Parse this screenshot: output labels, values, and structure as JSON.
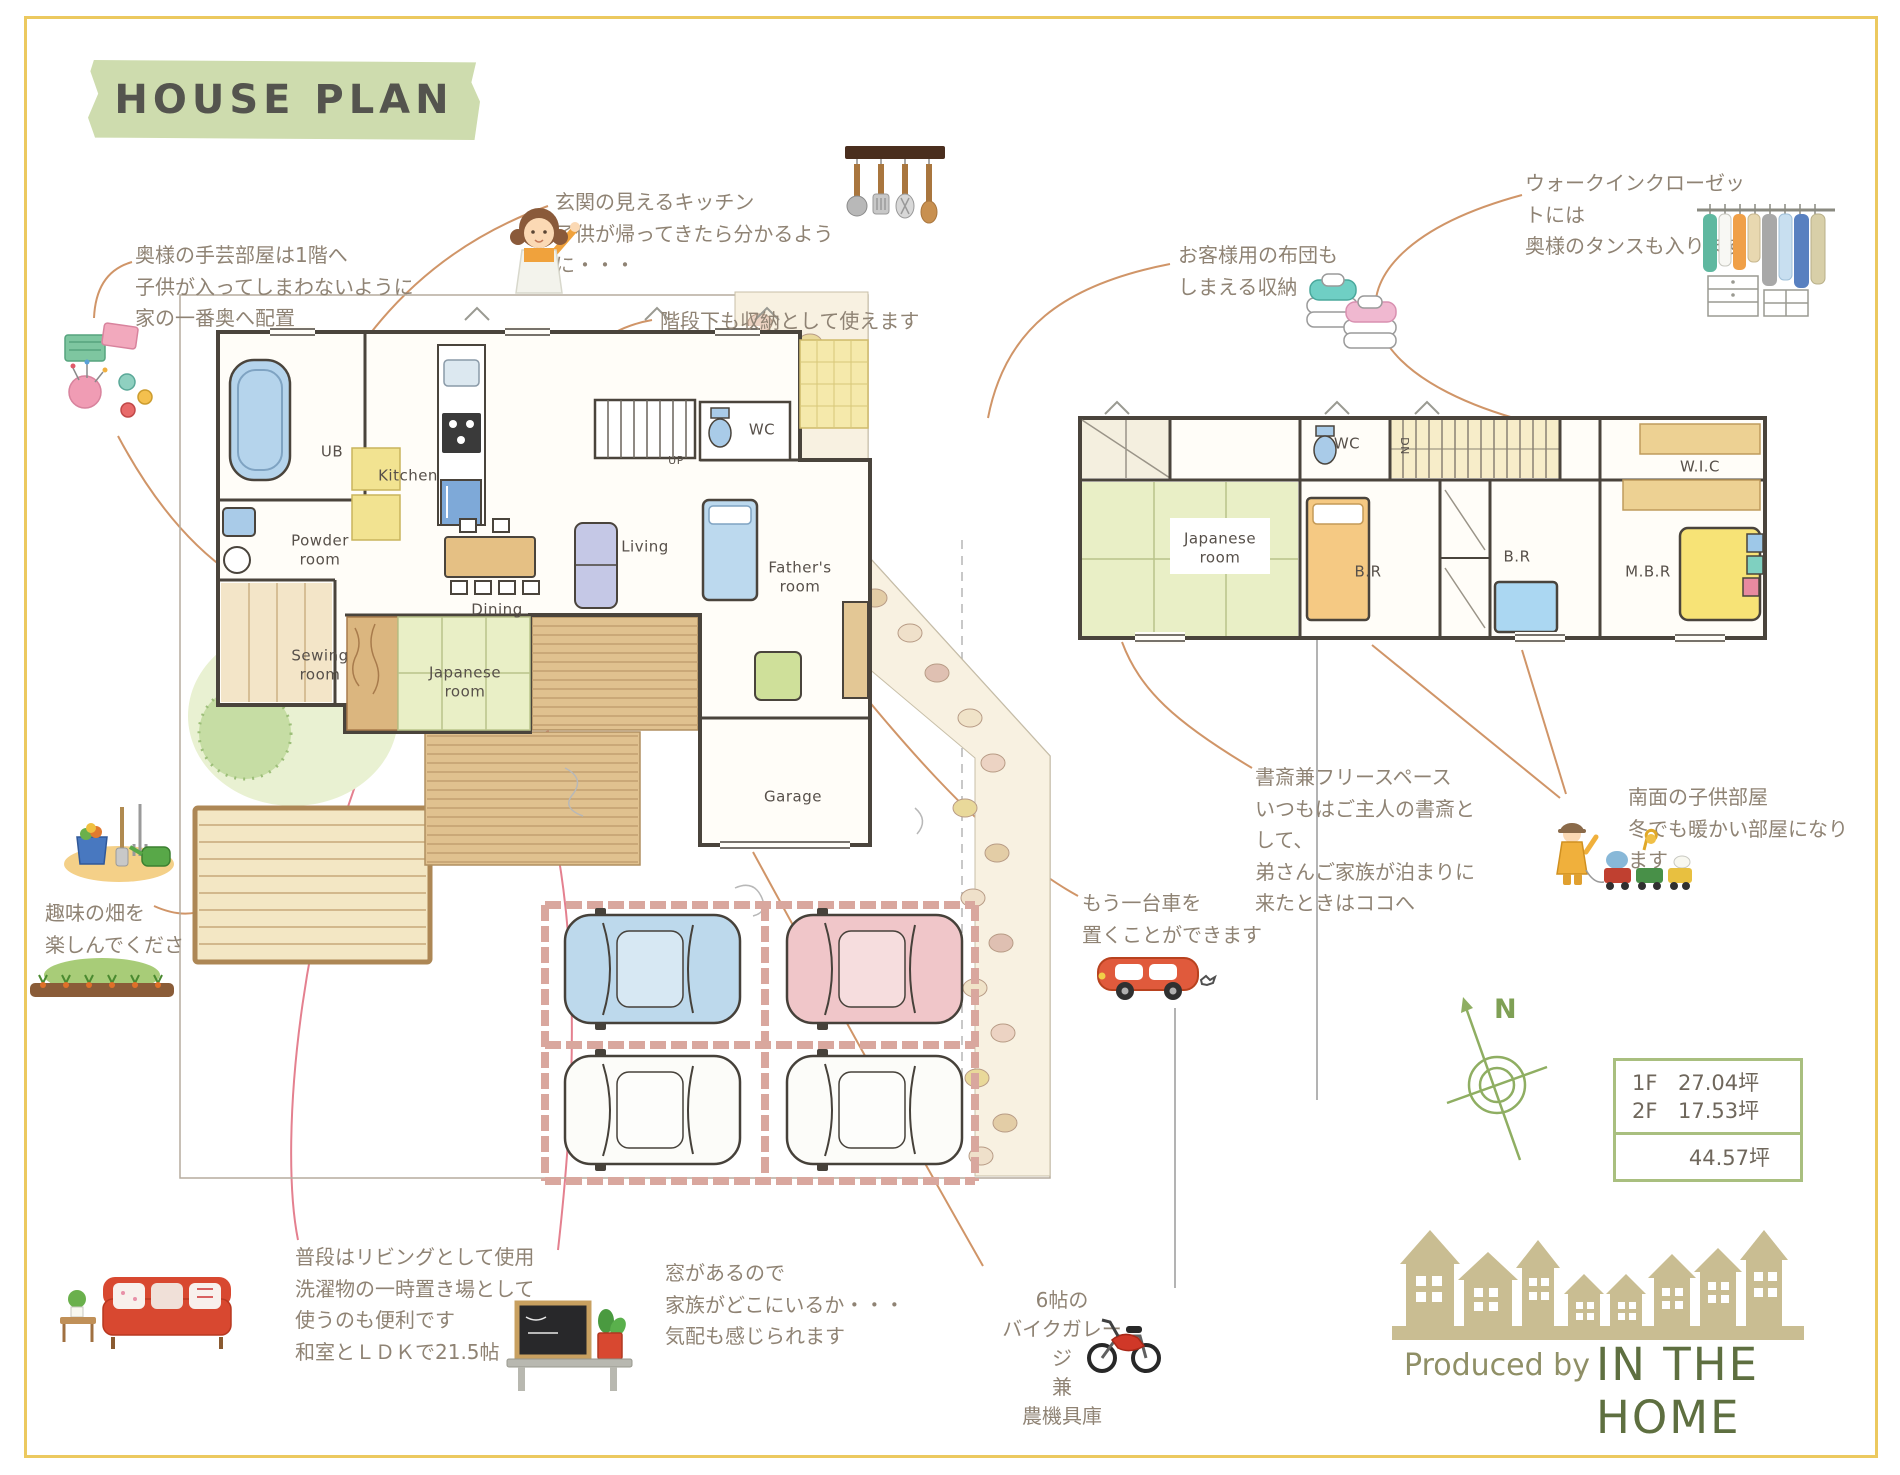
{
  "banner": {
    "title": "HOUSE PLAN"
  },
  "notes": {
    "craft": [
      "奥様の手芸部屋は1階へ",
      "子供が入ってしまわないように",
      "家の一番奥へ配置"
    ],
    "kitchen": [
      "玄関の見えるキッチン",
      "子供が帰ってきたら分かるよう",
      "に・・・"
    ],
    "stairs": [
      "階段下も収納として使えます"
    ],
    "futon": [
      "お客様用の布団も",
      "しまえる収納"
    ],
    "wic": [
      "ウォークインクローゼッ",
      "トには",
      "奥様のタンスも入ります"
    ],
    "study": [
      "書斎兼フリースペース",
      "いつもはご主人の書斎と",
      "して、",
      "弟さんご家族が泊まりに",
      "来たときはココへ"
    ],
    "kids": [
      "南面の子供部屋",
      "冬でも暖かい部屋になり",
      "ます"
    ],
    "car": [
      "もう一台車を",
      "置くことができます"
    ],
    "field": [
      "趣味の畑を",
      "楽しんでくださ",
      "い"
    ],
    "living": [
      "普段はリビングとして使用",
      "洗濯物の一時置き場として",
      "使うのも便利です"
    ],
    "ldk": [
      "和室とＬＤＫで21.5帖"
    ],
    "window": [
      "窓があるので",
      "家族がどこにいるか・・・",
      "気配も感じられます"
    ],
    "bike": [
      "6帖の",
      "バイクガレー",
      "ジ",
      "兼",
      "農機具庫"
    ]
  },
  "floor1": {
    "ub": "UB",
    "kitchen": "Kitchen",
    "powder": [
      "Powder",
      "room"
    ],
    "sewing": [
      "Sewing",
      "room"
    ],
    "japanese": [
      "Japanese",
      "room"
    ],
    "dining": "Dining",
    "living": "Living",
    "father": [
      "Father's",
      "room"
    ],
    "garage": "Garage",
    "wc": "WC",
    "up": "UP"
  },
  "floor2": {
    "japanese": [
      "Japanese",
      "room"
    ],
    "wc": "WC",
    "dn": "DN",
    "br_left": "B.R",
    "br_right": "B.R",
    "wic": "W.I.C",
    "mbr": "M.B.R"
  },
  "area_table": {
    "rows": [
      {
        "label": "1F",
        "value": "27.04坪"
      },
      {
        "label": "2F",
        "value": "17.53坪"
      }
    ],
    "total": "44.57坪"
  },
  "compass": {
    "north": "N"
  },
  "footer": {
    "produced_by": "Produced by",
    "brand": "IN THE HOME"
  },
  "colors": {
    "accent_tape": "#cedcae",
    "frame": "#ecc95f",
    "leader": "#d09568",
    "brand_green": "#5e6f40"
  }
}
